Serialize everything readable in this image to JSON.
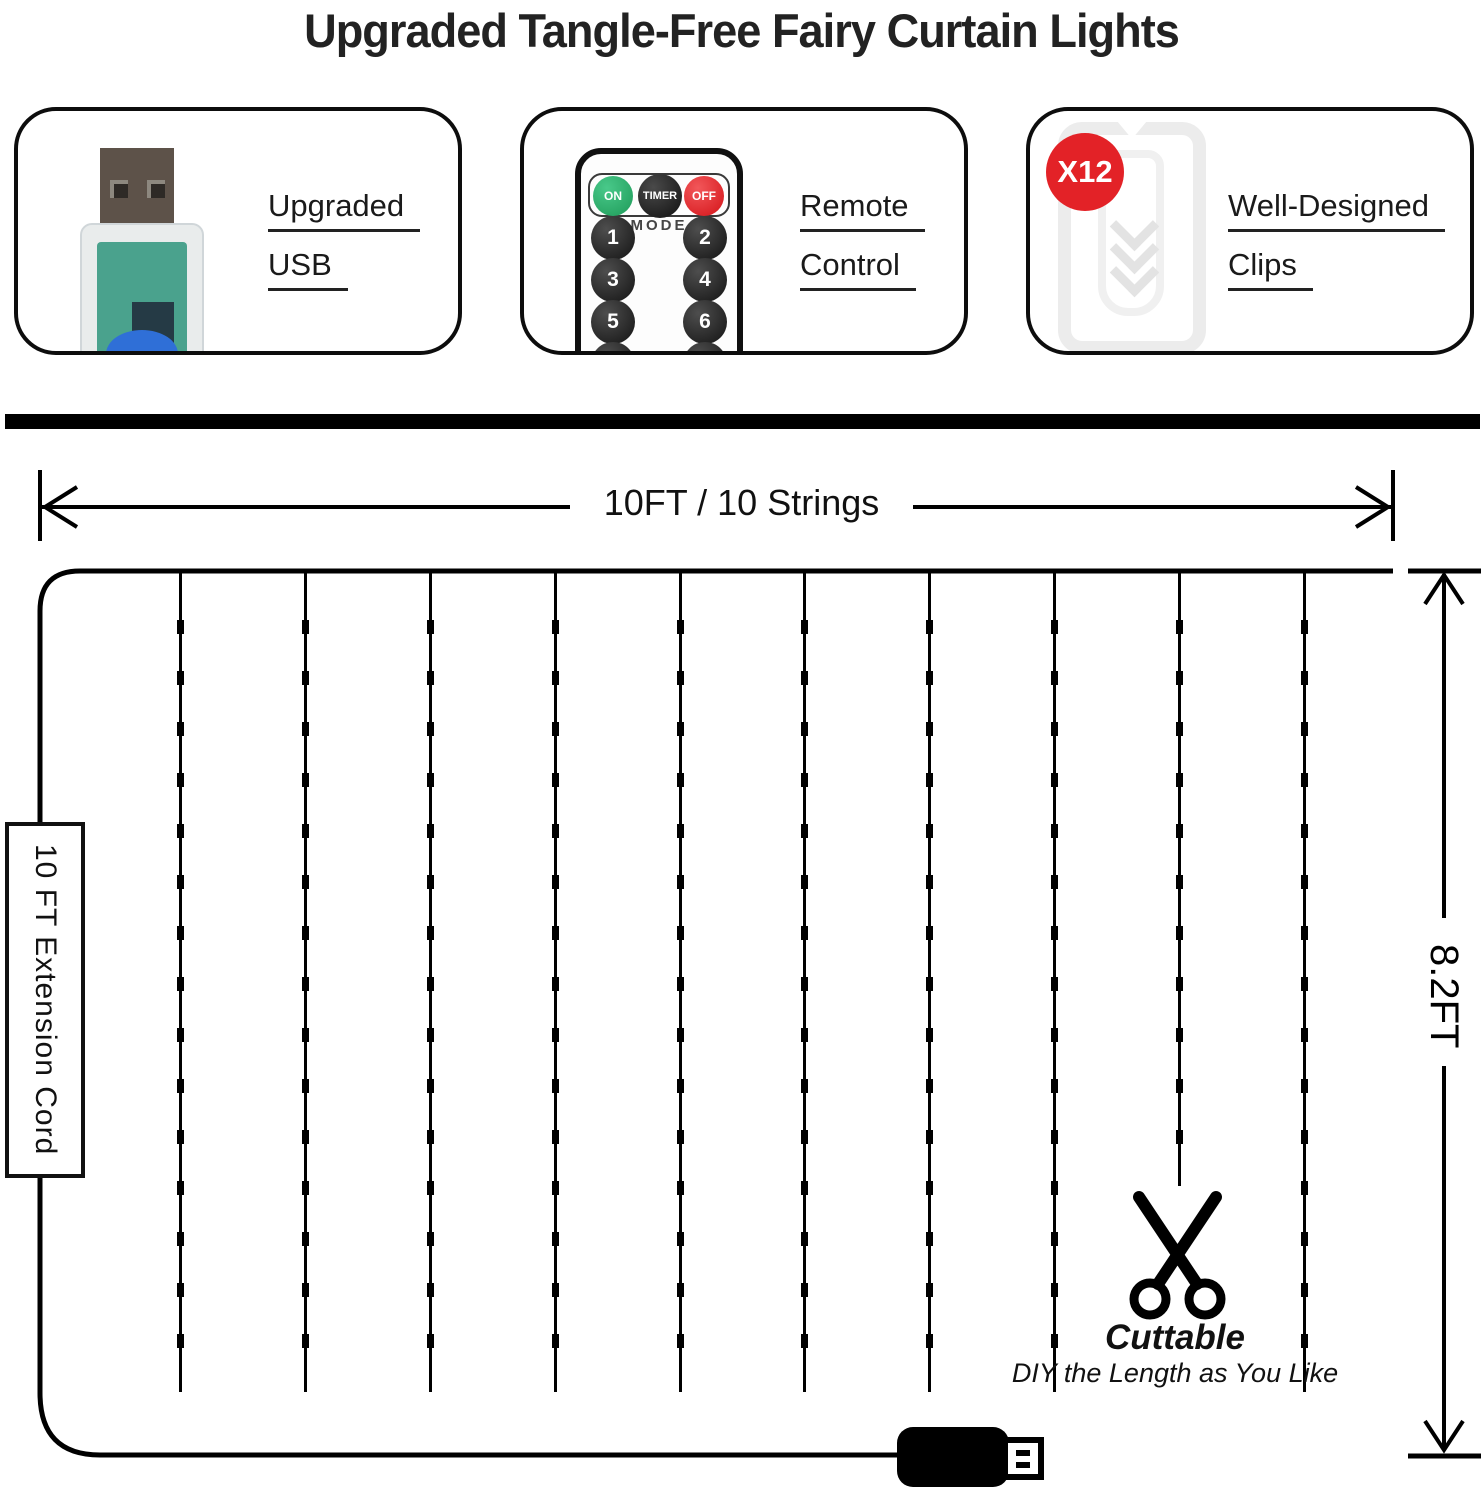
{
  "title": "Upgraded Tangle-Free Fairy Curtain Lights",
  "features": {
    "usb": {
      "line1": "Upgraded",
      "line2": "USB"
    },
    "remote": {
      "line1": "Remote",
      "line2": "Control"
    },
    "clips": {
      "line1": "Well-Designed",
      "line2": "Clips",
      "badge": "X12"
    }
  },
  "remote_control": {
    "on_label": "ON",
    "timer_label": "TIMER",
    "off_label": "OFF",
    "mode_label": "MODE",
    "mode_buttons": [
      "1",
      "2",
      "3",
      "4",
      "5",
      "6"
    ]
  },
  "diagram": {
    "width_label": "10FT / 10 Strings",
    "height_label": "8.2FT",
    "extension_cord_label": "10 FT Extension Cord",
    "cuttable_title": "Cuttable",
    "cuttable_subtitle": "DIY the Length as You Like",
    "strings_count": 10,
    "leds_per_string": 15,
    "cut_string_index": 8
  },
  "colors": {
    "badge_red": "#e32227",
    "remote_on_green": "#1e9a58",
    "remote_off_red": "#d41318",
    "usb_pcb_teal": "#4aa28d",
    "usb_component_blue": "#2f6fd7",
    "line_black": "#000000"
  }
}
